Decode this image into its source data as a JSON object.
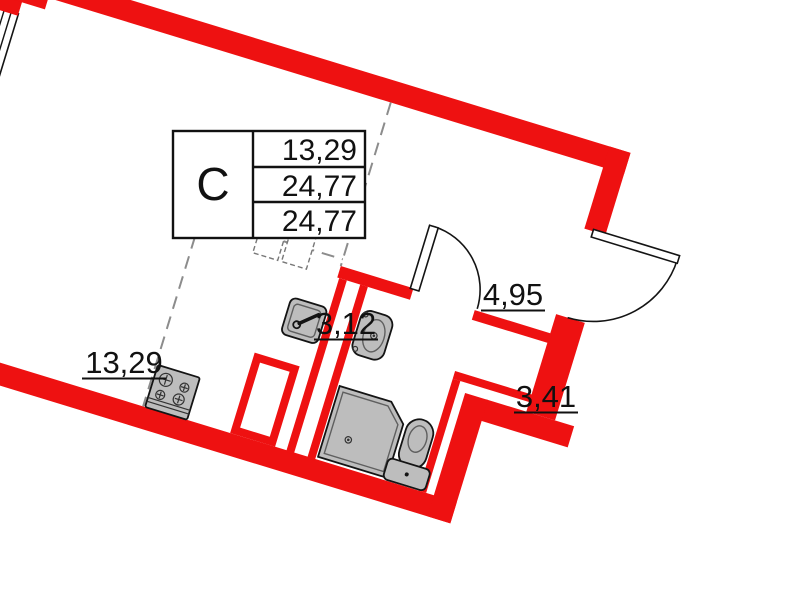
{
  "legend": {
    "unit_type": "С",
    "rows": [
      "13,29",
      "24,77",
      "24,77"
    ]
  },
  "rooms": [
    {
      "name": "living-room",
      "area": "13,29"
    },
    {
      "name": "kitchen-zone",
      "area": "3,12"
    },
    {
      "name": "hallway",
      "area": "4,95"
    },
    {
      "name": "bathroom",
      "area": "3,41"
    }
  ],
  "fixtures": [
    "stove",
    "kitchen-sink",
    "washbasin",
    "shower-tray",
    "toilet",
    "ventilation-shaft",
    "entrance-door",
    "bathroom-door",
    "window"
  ],
  "colors": {
    "wall": "#ee1111",
    "fixture": "#bdbdbd",
    "dash": "#8c8c8c",
    "line": "#141414"
  }
}
